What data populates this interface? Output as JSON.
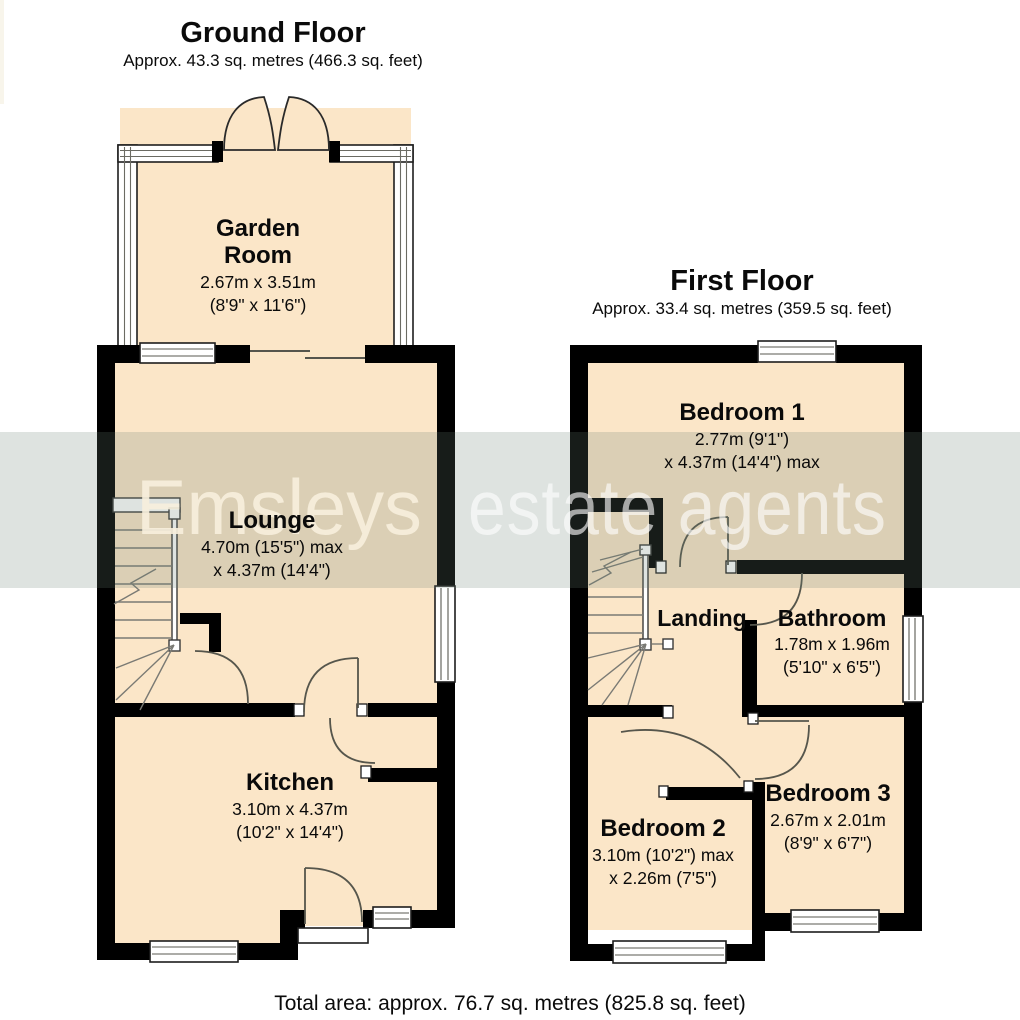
{
  "ground_floor": {
    "title": "Ground Floor",
    "area": "Approx. 43.3 sq. metres (466.3 sq. feet)",
    "garden_room": {
      "name": "Garden Room",
      "metric": "2.67m x 3.51m",
      "imperial": "(8'9\" x 11'6\")"
    },
    "lounge": {
      "name": "Lounge",
      "metric": "4.70m (15'5\") max",
      "imperial": "x 4.37m (14'4\")"
    },
    "kitchen": {
      "name": "Kitchen",
      "metric": "3.10m x 4.37m",
      "imperial": "(10'2\" x 14'4\")"
    }
  },
  "first_floor": {
    "title": "First Floor",
    "area": "Approx. 33.4 sq. metres (359.5 sq. feet)",
    "bedroom1": {
      "name": "Bedroom 1",
      "metric": "2.77m (9'1\")",
      "imperial": "x 4.37m (14'4\") max"
    },
    "landing": {
      "name": "Landing"
    },
    "bathroom": {
      "name": "Bathroom",
      "metric": "1.78m x 1.96m",
      "imperial": "(5'10\" x 6'5\")"
    },
    "bedroom2": {
      "name": "Bedroom 2",
      "metric": "3.10m (10'2\") max",
      "imperial": "x 2.26m (7'5\")"
    },
    "bedroom3": {
      "name": "Bedroom 3",
      "metric": "2.67m x 2.01m",
      "imperial": "(8'9\" x 6'7\")"
    }
  },
  "footer": {
    "total": "Total area: approx. 76.7 sq. metres (825.8 sq. feet)"
  },
  "watermark": {
    "brand": "Emsleys",
    "separator": "|",
    "tagline": "estate agents"
  },
  "colors": {
    "room_fill": "#fbe6c8",
    "wall": "#000000",
    "watermark_band": "rgba(105,128,115,0.22)"
  }
}
